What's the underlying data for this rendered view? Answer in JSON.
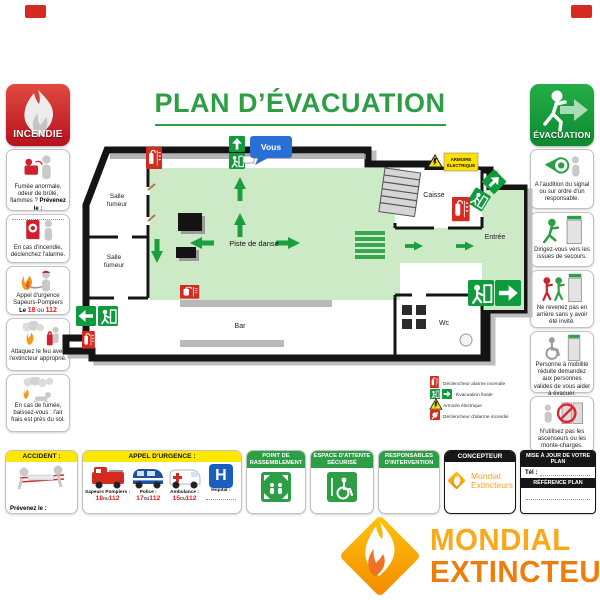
{
  "title": "PLAN D’ÉVACUATION",
  "incendie": {
    "badge": "INCENDIE",
    "steps": [
      {
        "text": "Fumée anormale, odeur de brûlé, flammes ?",
        "emph": "Prévenez le :"
      },
      {
        "text": "En cas d'incendie, déclenchez l'alarme."
      },
      {
        "text": "Appel d'urgence Sapeurs-Pompiers",
        "prefix": "Le",
        "n1": "18",
        "sep": "ou",
        "n2": "112"
      },
      {
        "text": "Attaquez le feu avec l'extincteur approprié."
      },
      {
        "text": "En cas de fumée, baissez-vous : l'air frais est près du sol."
      }
    ]
  },
  "evacuation": {
    "badge": "ÉVACUATION",
    "steps": [
      {
        "text": "A l'audition du signal ou sur ordre d'un responsable."
      },
      {
        "text": "Dirigez-vous vers les issues de secours."
      },
      {
        "text": "Ne revenez pas en arrière sans y avoir été invité."
      },
      {
        "text": "Personne à mobilité réduite demandez aux personnes valides de vous aider à évacuer."
      },
      {
        "text": "N'utilisez pas les ascenseurs ou les monte-charges."
      }
    ]
  },
  "plan": {
    "you_are_here": "Vous",
    "salle_l1": "Salle",
    "salle_l2": "fumeur",
    "piste": "Piste de danse",
    "bar": "Bar",
    "caisse": "Caisse",
    "entree": "Entrée",
    "wc": "Wc",
    "armoire_l1": "ARMOIRE",
    "armoire_l2": "ÉLECTRIQUE",
    "legend": [
      {
        "icon": "extinguisher-sign",
        "label": "Déclencheur alarme incendie"
      },
      {
        "icon": "exit-run-and-arrow-sign",
        "label": "Évacuation finale"
      },
      {
        "icon": "warning-triangle",
        "label": "Armoire électrique"
      },
      {
        "icon": "alarm-call-point",
        "label": "Déclencheur d'alarme incendie"
      }
    ]
  },
  "footer": {
    "accident": {
      "header": "ACCIDENT :",
      "emph": "Prévenez le :"
    },
    "appel": {
      "header": "APPEL D'URGENCE :",
      "h": "H",
      "items": [
        {
          "label": "Sapeurs Pompiers :",
          "n1": "18",
          "sep": "ou",
          "n2": "112"
        },
        {
          "label": "Police :",
          "n1": "17",
          "sep": "ou",
          "n2": "112"
        },
        {
          "label": "Ambulance :",
          "n1": "15",
          "sep": "ou",
          "n2": "112"
        },
        {
          "label": "Hopital :"
        }
      ]
    },
    "point": {
      "header": "POINT DE RASSEMBLEMENT"
    },
    "espace": {
      "header": "ESPACE D'ATTENTE SÉCURISÉ"
    },
    "responsables": {
      "header": "RESPONSABLES D'INTERVENTION"
    },
    "concepteur": {
      "header": "CONCEPTEUR",
      "brand1": "Mondial",
      "brand2": "Extincteurs"
    },
    "mise": {
      "header": "MISE À JOUR DE VOTRE PLAN",
      "tel": "Tél :",
      "ref": "RÉFÉRENCE PLAN"
    }
  },
  "logo": {
    "line1": "MONDIAL",
    "line2": "EXTINCTEUR"
  }
}
